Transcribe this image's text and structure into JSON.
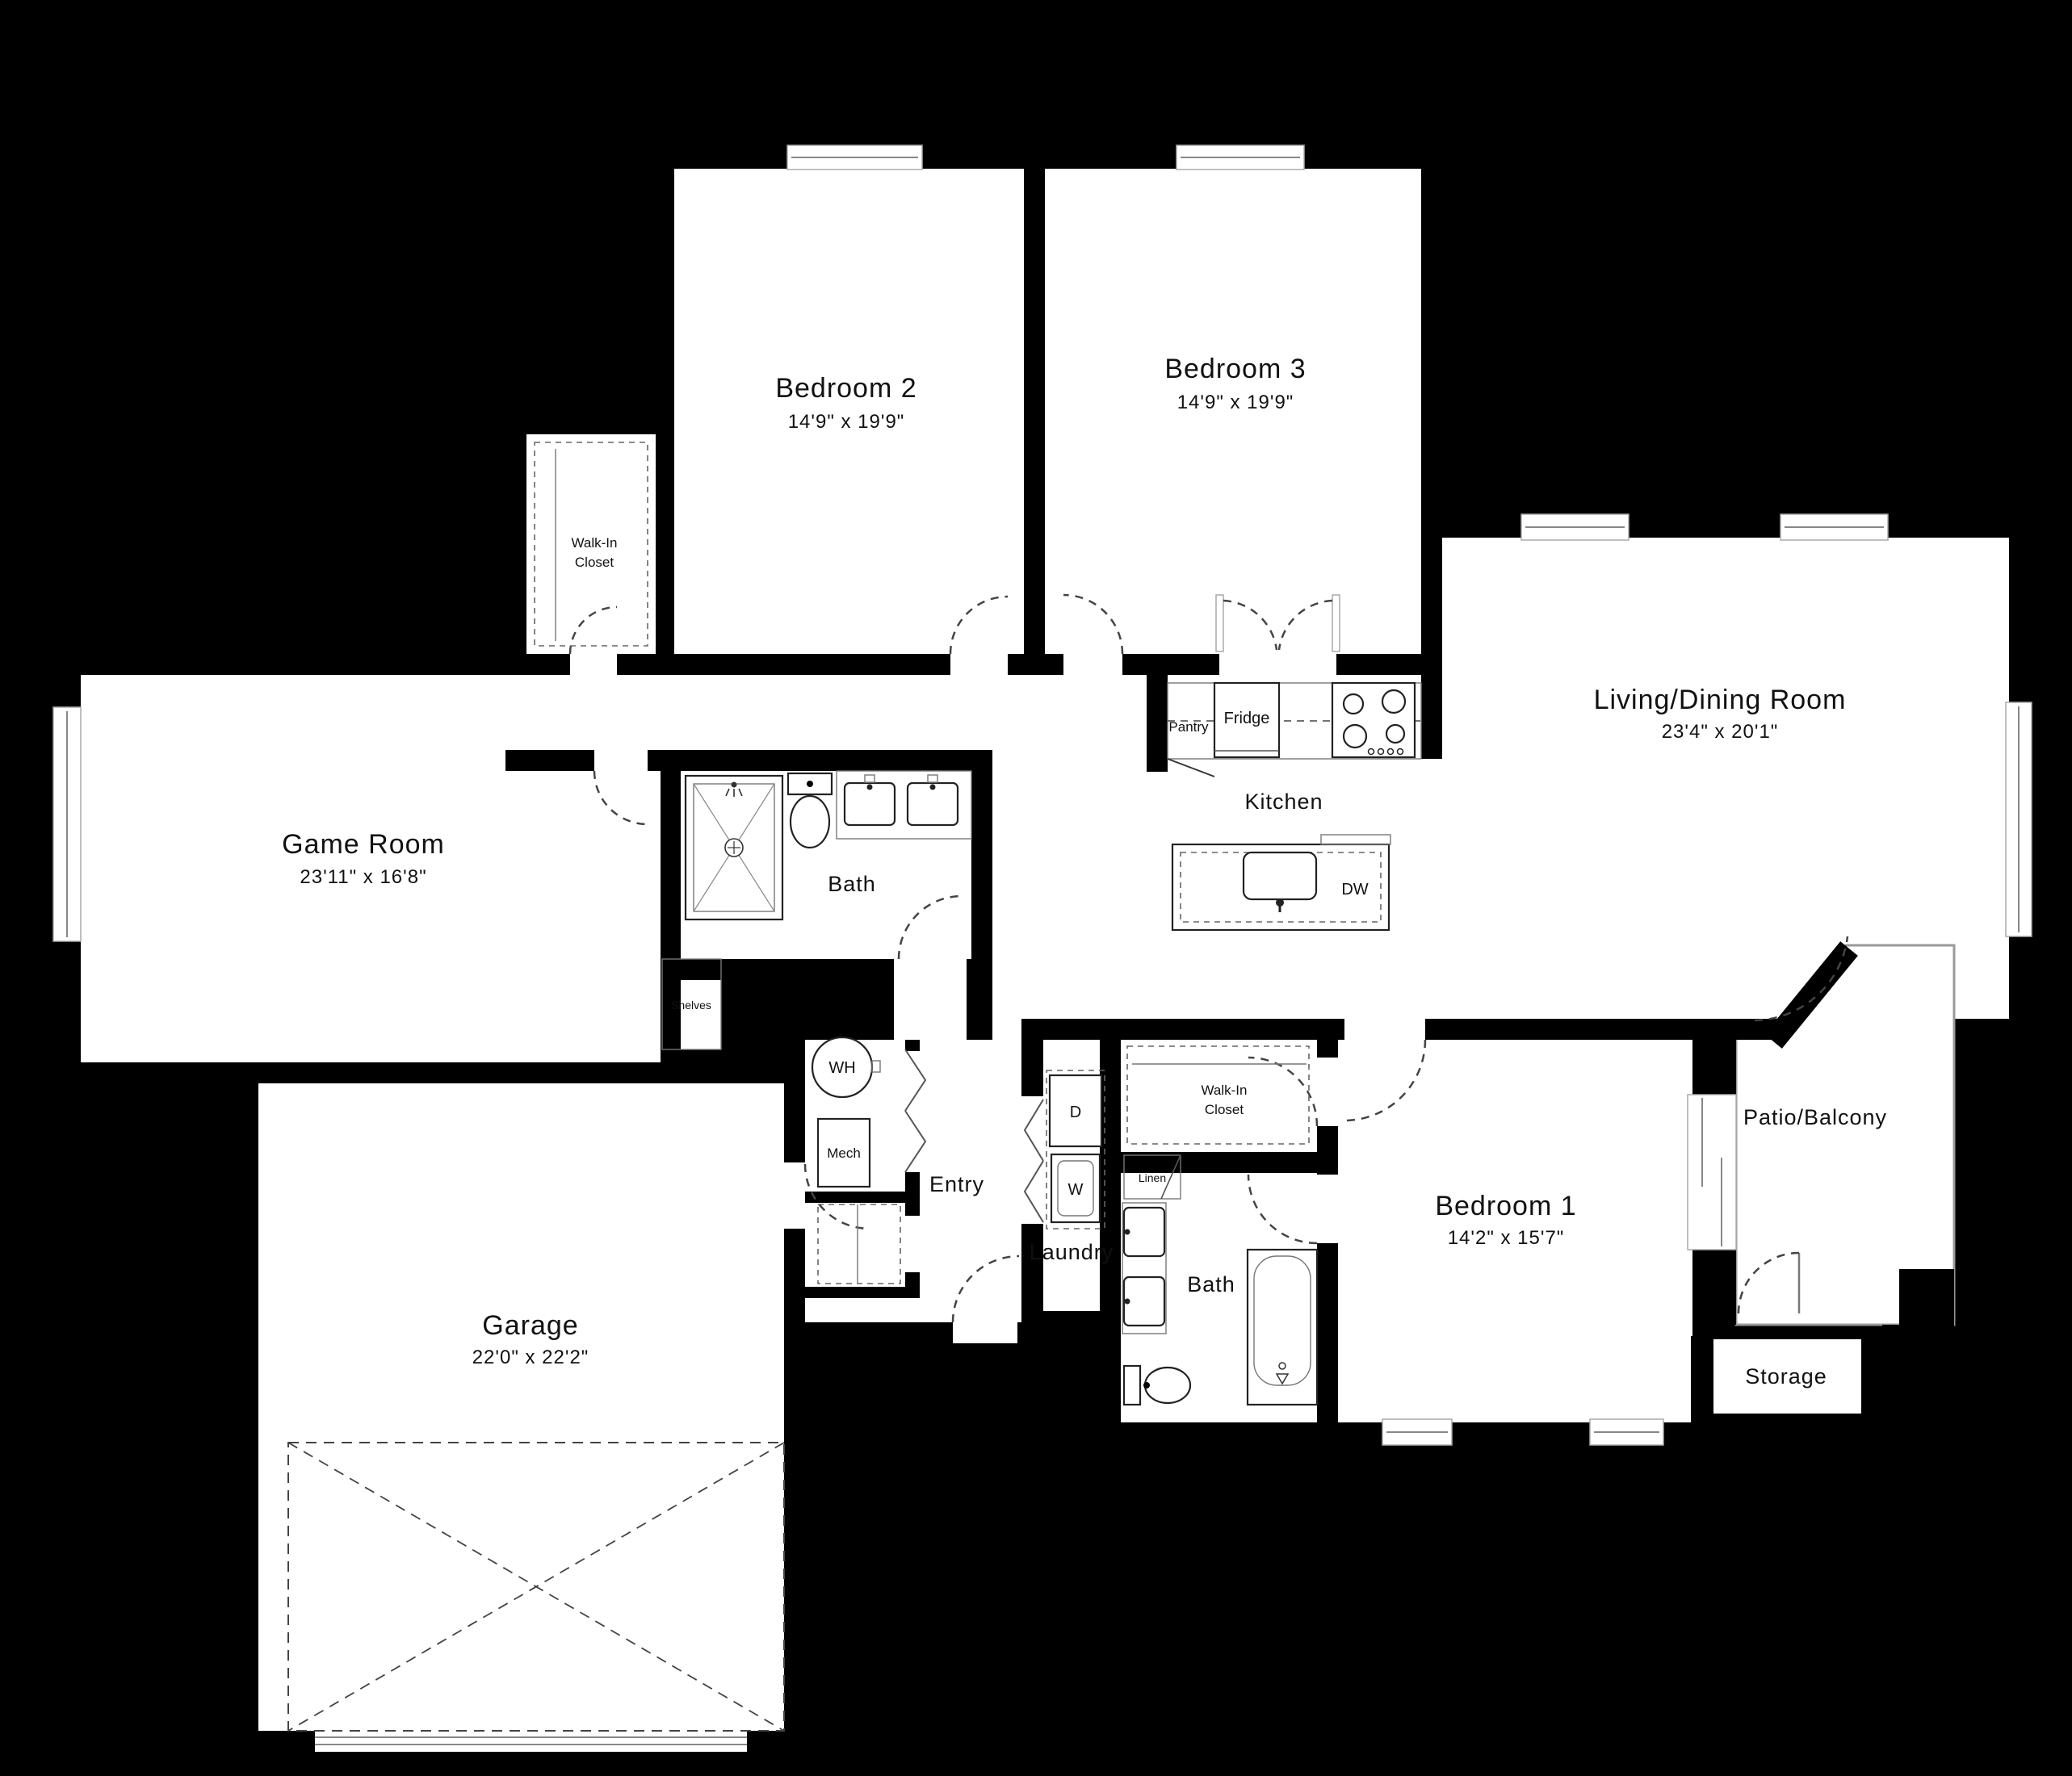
{
  "plan_title": "Floor Plan",
  "colors": {
    "background": "#000000",
    "floor": "#ffffff",
    "wall": "#000000",
    "window_gray": "#9a9a9a",
    "text": "#111111"
  },
  "rooms": {
    "bedroom2": {
      "label": "Bedroom 2",
      "dims": "14'9\" x 19'9\""
    },
    "bedroom3": {
      "label": "Bedroom 3",
      "dims": "14'9\" x 19'9\""
    },
    "living_dining": {
      "label": "Living/Dining Room",
      "dims": "23'4\" x 20'1\""
    },
    "game_room": {
      "label": "Game Room",
      "dims": "23'11\" x 16'8\""
    },
    "bedroom1": {
      "label": "Bedroom 1",
      "dims": "14'2\" x 15'7\""
    },
    "garage": {
      "label": "Garage",
      "dims": "22'0\" x 22'2\""
    },
    "kitchen": {
      "label": "Kitchen"
    },
    "bath_upper": {
      "label": "Bath"
    },
    "bath_lower": {
      "label": "Bath"
    },
    "entry": {
      "label": "Entry"
    },
    "laundry": {
      "label": "Laundry"
    },
    "walk_in_closet_top": {
      "line1": "Walk-In",
      "line2": "Closet"
    },
    "walk_in_closet_right": {
      "line1": "Walk-In",
      "line2": "Closet"
    },
    "patio": {
      "label": "Patio/Balcony"
    },
    "storage": {
      "label": "Storage"
    }
  },
  "fixtures": {
    "pantry": "Pantry",
    "fridge": "Fridge",
    "dishwasher": "DW",
    "water_heater": "WH",
    "mechanical": "Mech",
    "dryer": "D",
    "washer": "W",
    "linen": "Linen",
    "shelves": "Shelves"
  }
}
